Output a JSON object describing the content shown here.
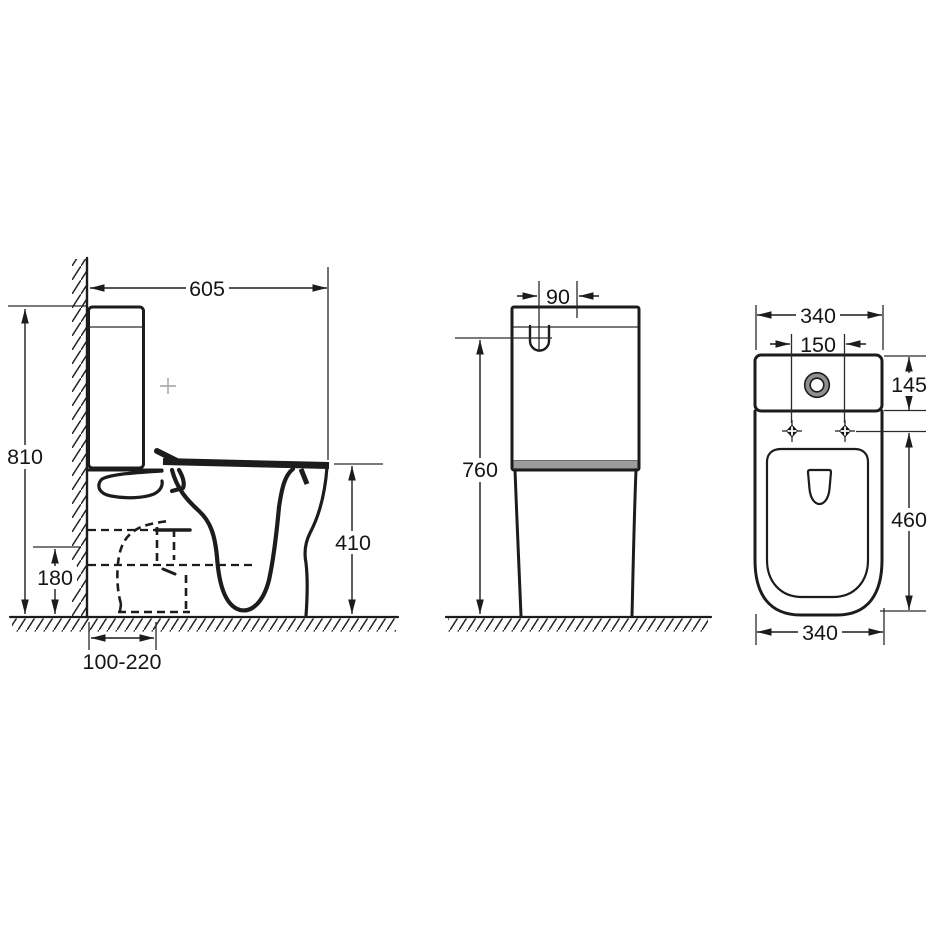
{
  "drawing": {
    "description": "Three-view technical dimension drawing of a close-coupled toilet",
    "side_view": {
      "label": "side elevation",
      "dimensions": {
        "depth": "605",
        "height": "810",
        "seat_height": "410",
        "outlet_center_height": "180",
        "outlet_setout_range": "100-220"
      }
    },
    "front_view": {
      "label": "front elevation",
      "dimensions": {
        "flush_button_offset": "90",
        "cistern_height": "760"
      }
    },
    "top_view": {
      "label": "plan view",
      "dimensions": {
        "overall_width": "340",
        "fixing_hole_spacing": "150",
        "cistern_depth": "145",
        "pan_length": "460",
        "base_width": "340"
      }
    },
    "colors": {
      "line": "#1c1c1c",
      "seat_band": "#9c9c9c",
      "button_ring": "#8f8f8f",
      "crosshair": "#a0a0a0"
    }
  }
}
